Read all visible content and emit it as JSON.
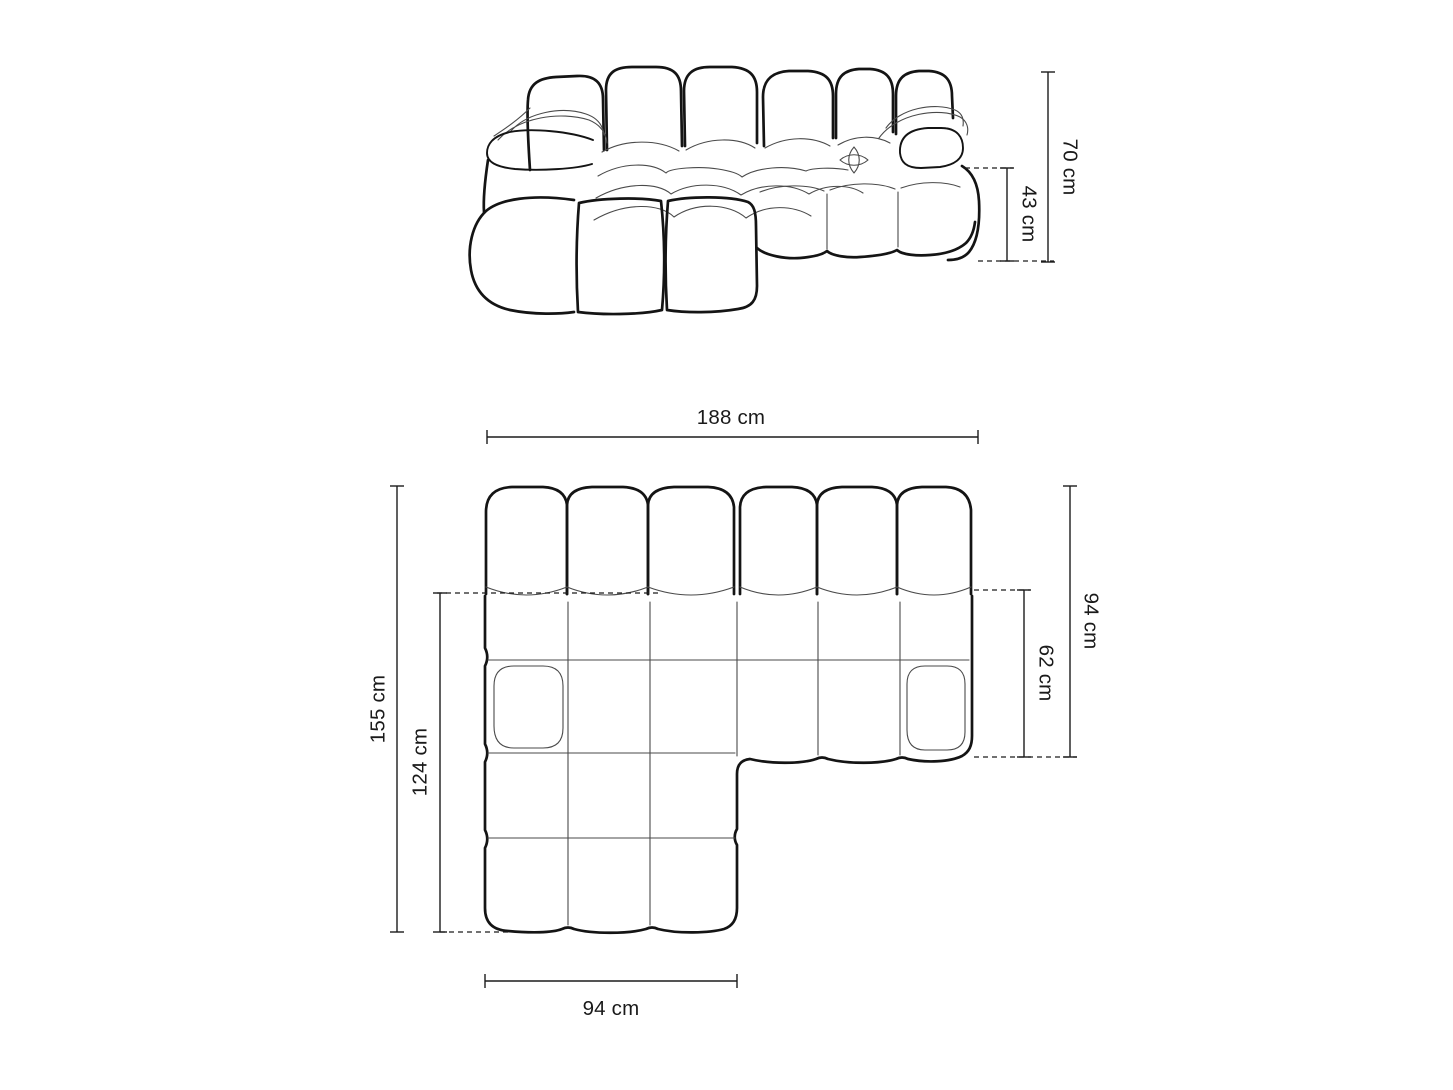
{
  "diagram": {
    "type": "furniture-dimension-drawing",
    "views": {
      "front": {
        "name": "front-elevation",
        "dims": {
          "total_height": "70 cm",
          "seat_height": "43 cm"
        }
      },
      "plan": {
        "name": "top-view",
        "dims": {
          "total_width": "188 cm",
          "total_depth": "155 cm",
          "chaise_depth": "124 cm",
          "right_depth": "94 cm",
          "seat_depth": "62 cm",
          "chaise_width": "94 cm"
        }
      }
    },
    "colors": {
      "background": "#ffffff",
      "outline_bold": "#141414",
      "outline_thin": "#4a4a4a",
      "dimension": "#1c1c1c"
    }
  }
}
